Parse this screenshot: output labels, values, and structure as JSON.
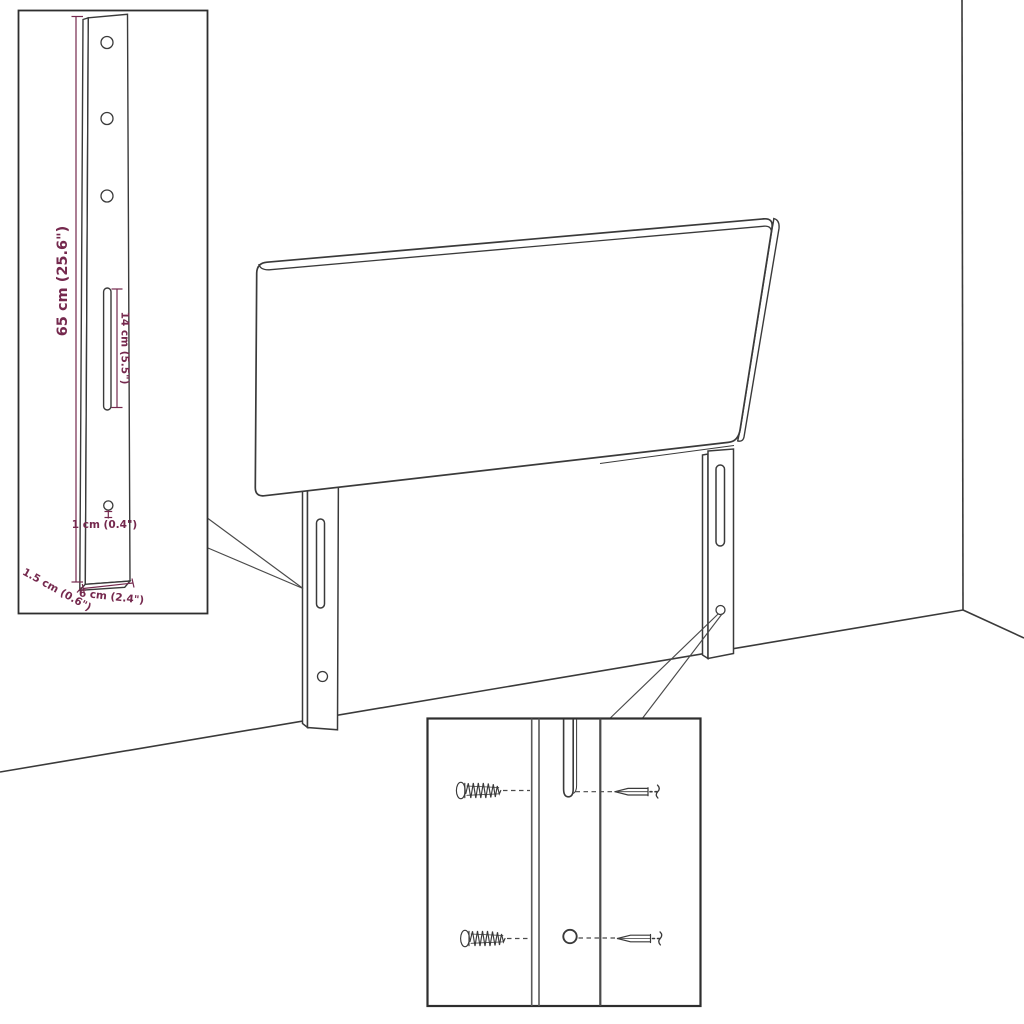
{
  "diagram": {
    "colors": {
      "line": "#3a3a3a",
      "dimension": "#75294e",
      "leader": "#4a4a4a",
      "background": "#ffffff"
    },
    "bracket_inset": {
      "height_label": "65 cm (25.6\")",
      "slot_label": "14 cm (5.5\")",
      "hole_label": "1 cm (0.4\")",
      "depth_label": "1.5 cm (0.6\")",
      "width_label": "6 cm (2.4\")"
    }
  }
}
